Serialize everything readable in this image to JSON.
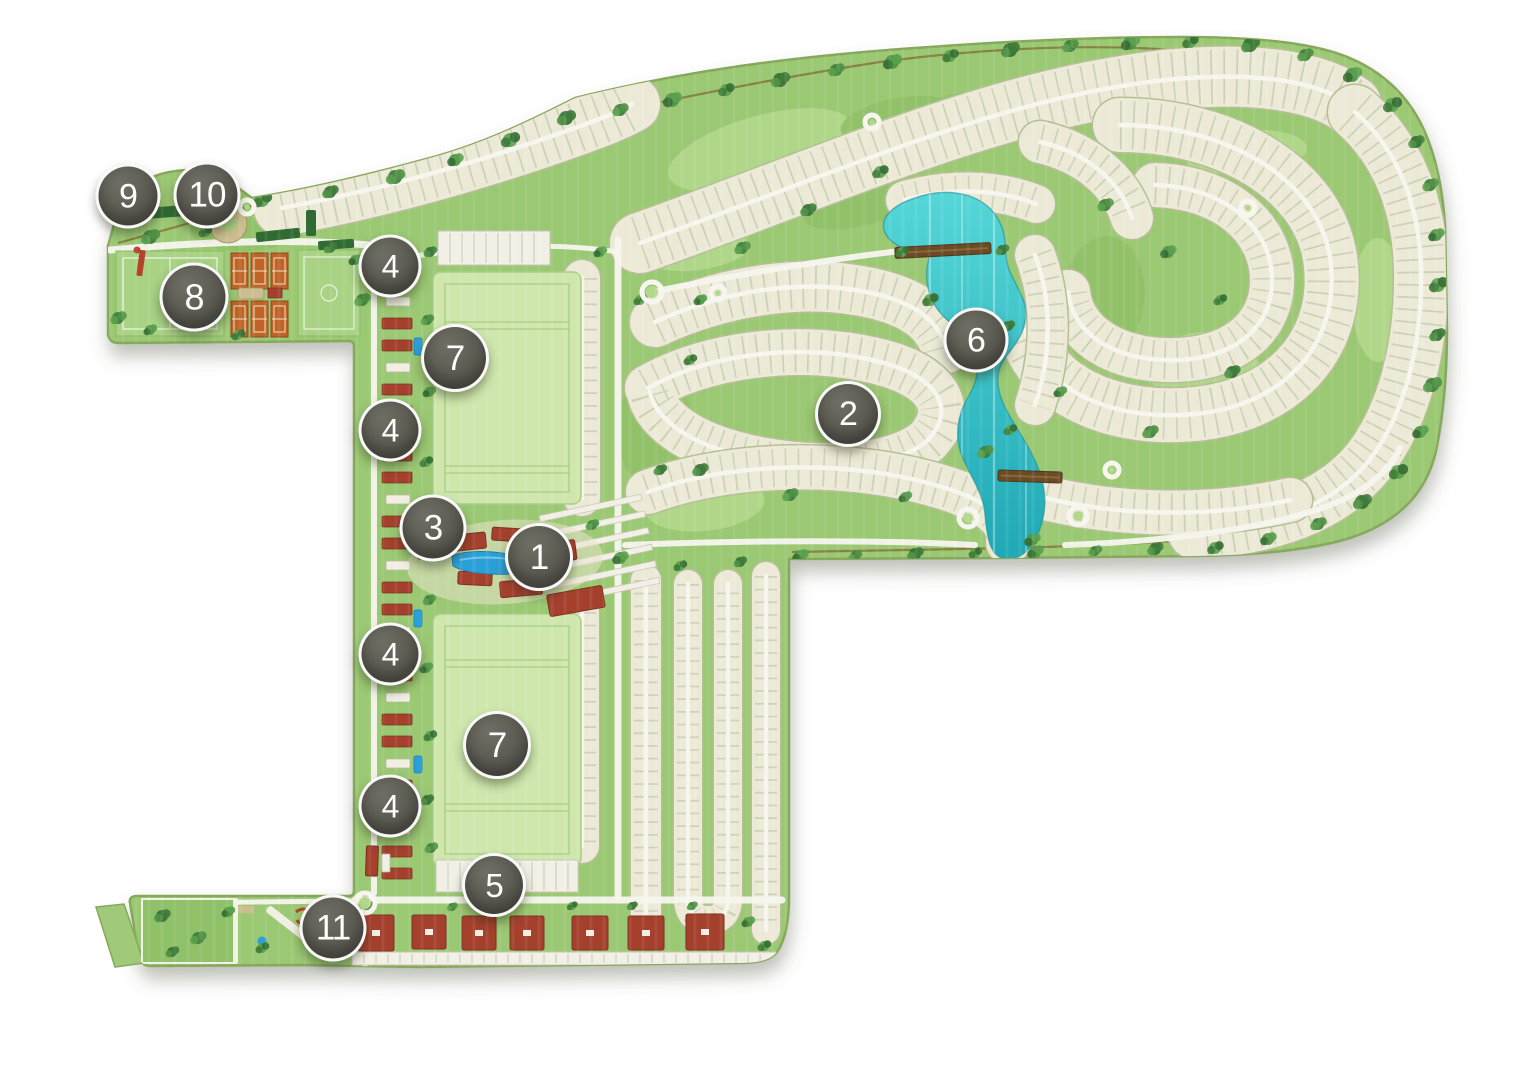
{
  "page": {
    "type": "community-master-plan-map",
    "background": "#ffffff"
  },
  "markers": [
    {
      "id": "marker-1",
      "label": "1",
      "x": 539,
      "y": 557,
      "size": 62
    },
    {
      "id": "marker-2",
      "label": "2",
      "x": 848,
      "y": 414,
      "size": 60
    },
    {
      "id": "marker-3",
      "label": "3",
      "x": 433,
      "y": 528,
      "size": 61
    },
    {
      "id": "marker-4-north",
      "label": "4",
      "x": 390,
      "y": 266,
      "size": 57
    },
    {
      "id": "marker-4-mid-north",
      "label": "4",
      "x": 390,
      "y": 430,
      "size": 57
    },
    {
      "id": "marker-4-mid-south",
      "label": "4",
      "x": 390,
      "y": 654,
      "size": 57
    },
    {
      "id": "marker-4-south",
      "label": "4",
      "x": 390,
      "y": 806,
      "size": 57
    },
    {
      "id": "marker-5",
      "label": "5",
      "x": 494,
      "y": 885,
      "size": 58
    },
    {
      "id": "marker-6",
      "label": "6",
      "x": 976,
      "y": 340,
      "size": 59
    },
    {
      "id": "marker-7-north",
      "label": "7",
      "x": 455,
      "y": 358,
      "size": 62
    },
    {
      "id": "marker-7-south",
      "label": "7",
      "x": 497,
      "y": 745,
      "size": 62
    },
    {
      "id": "marker-8",
      "label": "8",
      "x": 194,
      "y": 297,
      "size": 63
    },
    {
      "id": "marker-9",
      "label": "9",
      "x": 128,
      "y": 196,
      "size": 59
    },
    {
      "id": "marker-10",
      "label": "10",
      "x": 207,
      "y": 195,
      "size": 61
    },
    {
      "id": "marker-11",
      "label": "11",
      "x": 333,
      "y": 928,
      "size": 61
    }
  ],
  "map": {
    "colors": {
      "grass": "#9bc873",
      "grass_light": "#b3d88d",
      "grass_dark": "#8abb63",
      "lot": "#ece9d6",
      "lot_edge": "#b4bf95",
      "lot_tick": "#ccd1b5",
      "street": "#f7f6ee",
      "lake_light": "#55d6d7",
      "lake_dark": "#1fa9b5",
      "tree": "#47853f",
      "building": "#a5402d",
      "court": "#bf6426",
      "field": "#cfe7ad",
      "marker_fill": "#55544b",
      "bridge": "#6b4a26",
      "pool": "#2ba0d8"
    },
    "features": [
      "residential-lots",
      "lake",
      "bridges",
      "clubhouse-pool-area",
      "polo-fields",
      "tennis-courts",
      "soccer-fields",
      "equestrian-ring",
      "condo-strip",
      "parking-rows",
      "commercial-buildings",
      "entrance-roundabout",
      "playground"
    ]
  }
}
